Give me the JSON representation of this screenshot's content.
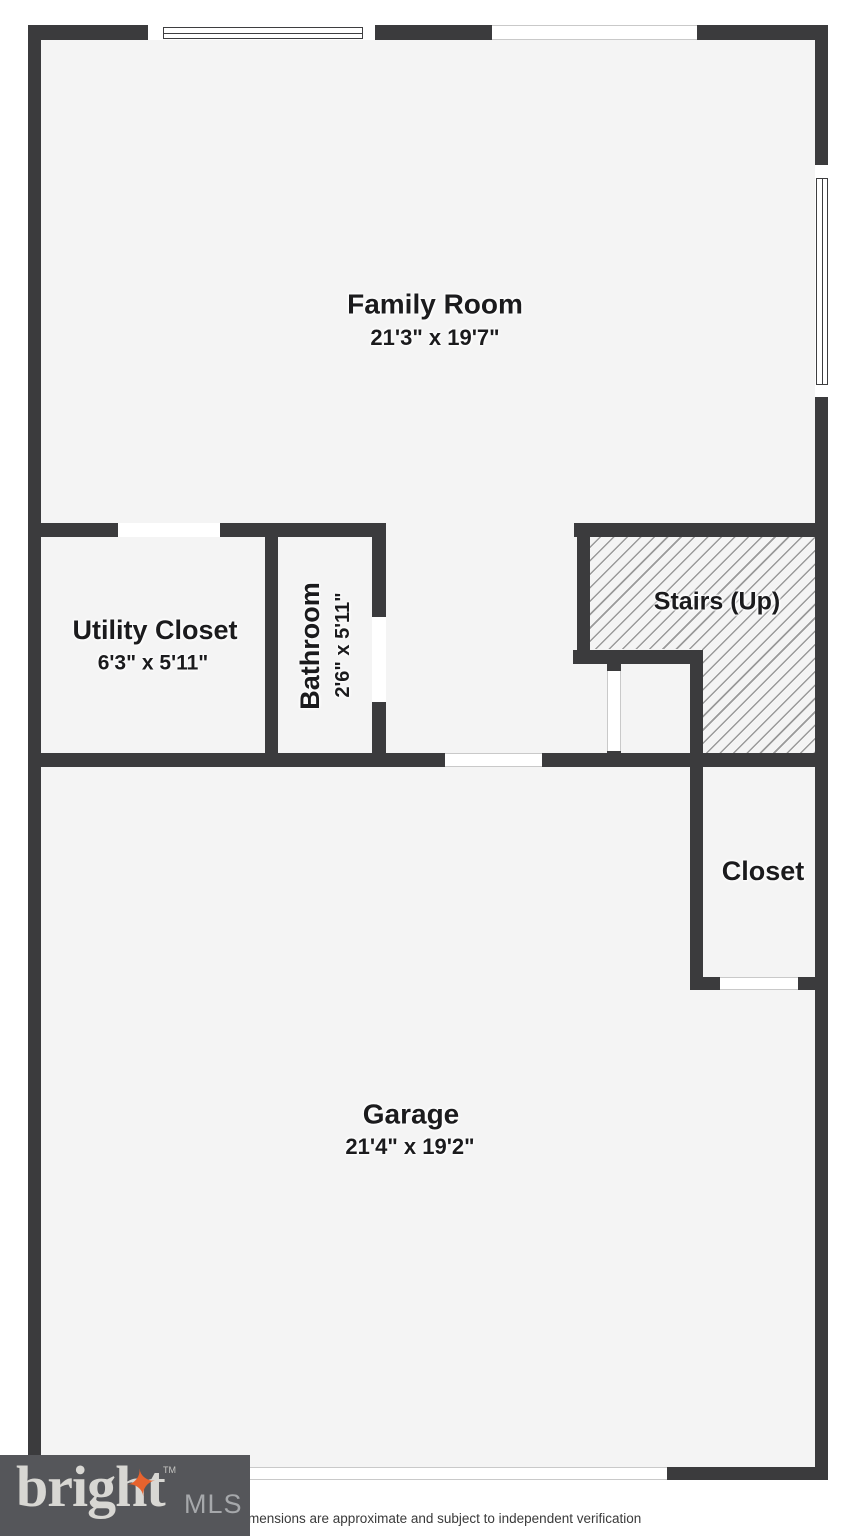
{
  "plan": {
    "type": "floor-plan",
    "rooms": {
      "family_room": {
        "name": "Family Room",
        "dims": "21'3\" x 19'7\""
      },
      "utility_closet": {
        "name": "Utility Closet",
        "dims": "6'3\" x 5'11\""
      },
      "bathroom": {
        "name": "Bathroom",
        "dims": "2'6\" x 5'11\""
      },
      "stairs": {
        "name": "Stairs (Up)"
      },
      "closet": {
        "name": "Closet"
      },
      "garage": {
        "name": "Garage",
        "dims": "21'4\" x 19'2\""
      }
    }
  },
  "footer": {
    "brand": "bright",
    "brand_tm": "TM",
    "brand_suffix": "MLS",
    "disclaimer": "mensions are approximate and subject to independent verification"
  },
  "colors": {
    "wall": "#3b3b3d",
    "floor": "#f4f4f4",
    "hatch_line": "#9a9a9a",
    "background": "#ffffff",
    "label_text": "#1b1b1d",
    "opening_line": "#c9c9c9",
    "logo_bg": "#55565a",
    "logo_text": "#d8d7d3",
    "logo_star": "#e7632e",
    "logo_mls": "#a6a8ab",
    "disclaimer_text": "#3a3a3a"
  }
}
